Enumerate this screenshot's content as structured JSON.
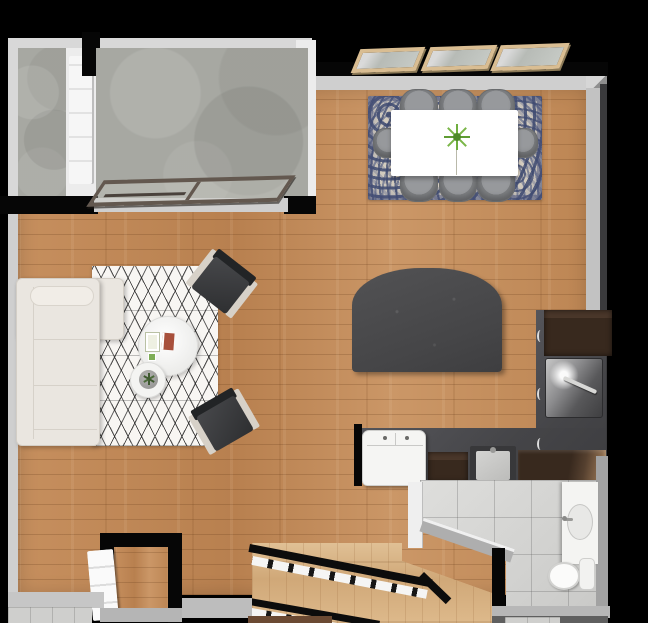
{
  "scene": {
    "title": "Studio apartment floor plan — top-down 3D render",
    "canvas": {
      "width": 648,
      "height": 623
    },
    "rooms": [
      {
        "name": "balcony-left",
        "floor": "concrete"
      },
      {
        "name": "balcony-main",
        "floor": "concrete"
      },
      {
        "name": "dining-area",
        "floor": "wood"
      },
      {
        "name": "living-area",
        "floor": "wood"
      },
      {
        "name": "kitchen",
        "floor": "wood"
      },
      {
        "name": "bathroom",
        "floor": "tile"
      },
      {
        "name": "closet",
        "floor": "wood"
      },
      {
        "name": "entry",
        "floor": "tile"
      },
      {
        "name": "staircase",
        "floor": "light-wood"
      }
    ],
    "furniture": {
      "dining": {
        "table": "white rectangular",
        "chairs_count": 8,
        "chair_color": "gray",
        "rug": "blue-cream ornate",
        "centerpiece": "green plant"
      },
      "living": {
        "sofa": "cream L-sectional",
        "coffee_table": "white round",
        "side_table": "white round with plant",
        "armchairs_count": 2,
        "armchair_color": "charcoal with light arms",
        "rug": "white with black diamond lattice"
      },
      "bed": {
        "color": "dark charcoal",
        "shape": "arched top"
      },
      "kitchen": {
        "cabinets": "dark espresso L-shape",
        "countertop": "charcoal",
        "appliances": [
          "refrigerator",
          "white range",
          "sink",
          "tall pantry cabinet"
        ]
      },
      "bathroom": {
        "fixtures": [
          "vanity with oval sink",
          "toilet",
          "diagonal half wall"
        ]
      },
      "stairs": {
        "flights": 2,
        "railing": "black",
        "treads": "white"
      }
    },
    "openings": {
      "windows_count": 3,
      "window_frame": "light wood",
      "doors": [
        "white balcony door",
        "dark sliding glass door",
        "white closet door",
        "white bathroom door"
      ]
    }
  },
  "palette": {
    "background": "#000000",
    "wood_floor": "#c18a58",
    "stair_wood": "#d9b587",
    "concrete": "#a7a8a2",
    "tile": "#d9d9d7",
    "wall_face": "#cfcfcf",
    "wall_core": "#060606",
    "cabinet_espresso": "#38291e",
    "countertop": "#454548",
    "bed_charcoal": "#4a4a4c",
    "chair_gray": "#8e9092",
    "sofa_cream": "#eae6e0",
    "dining_rug_blue": "#56618a",
    "living_rug": "#f8f6f3",
    "window_frame": "#d9bd92",
    "plant_green": "#6fae3e"
  }
}
